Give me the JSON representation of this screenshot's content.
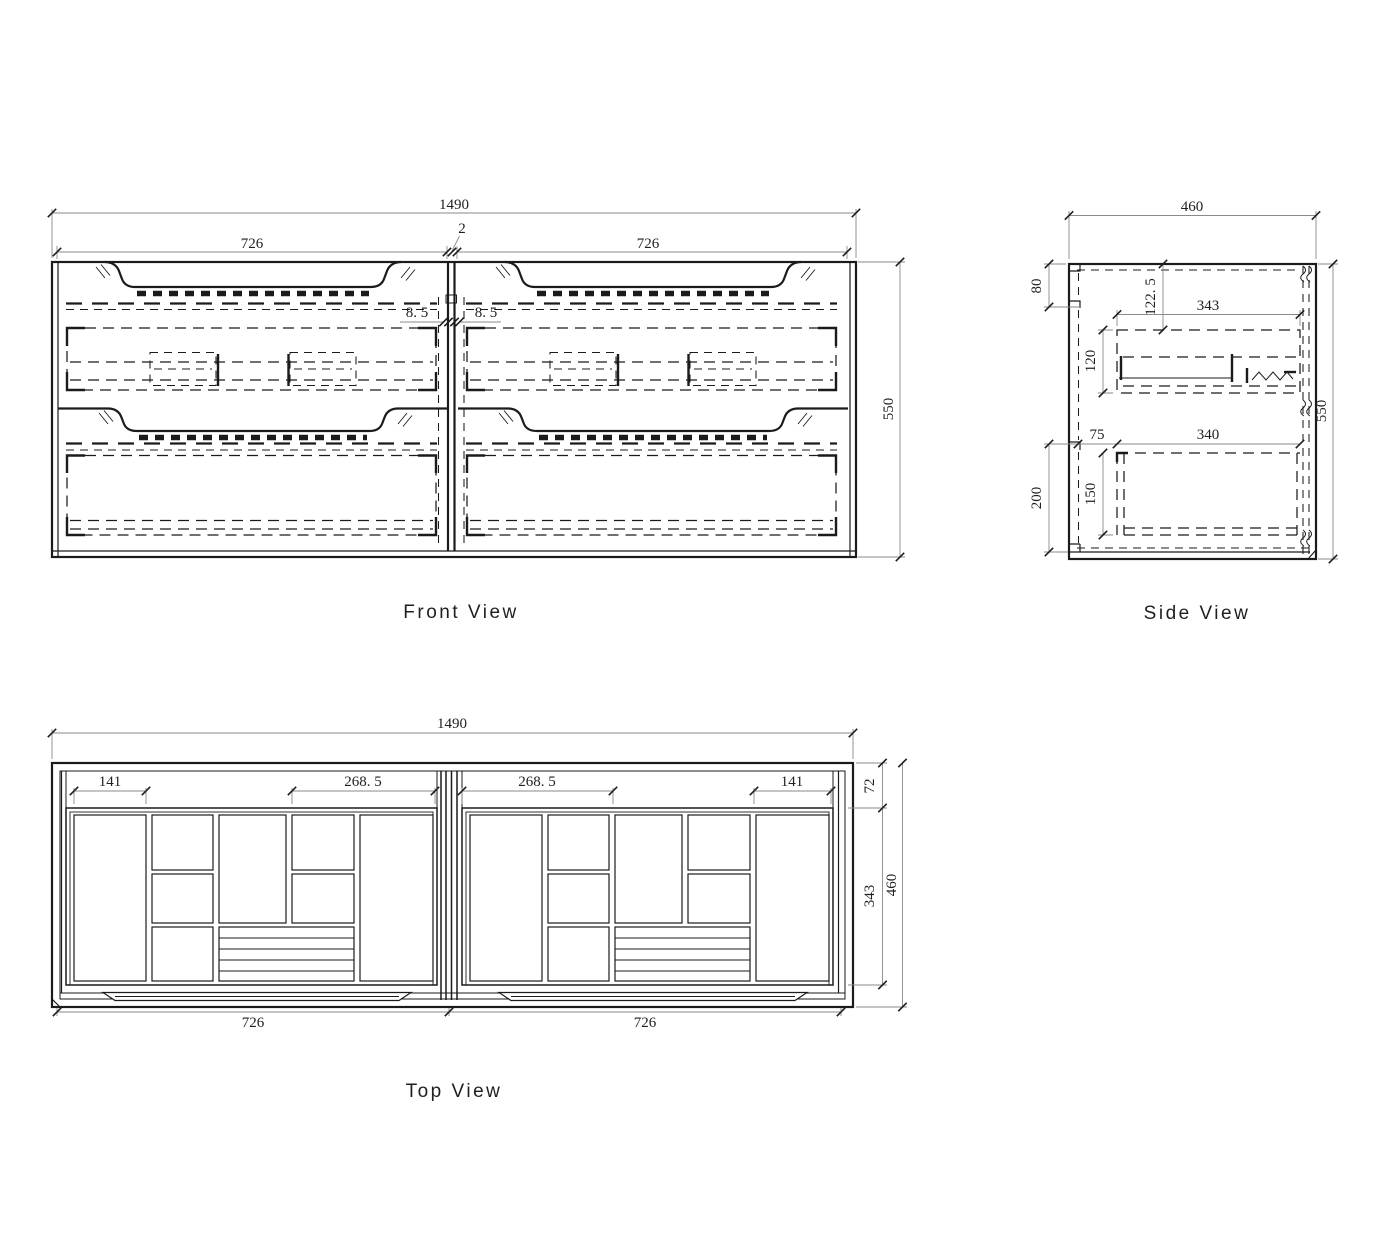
{
  "sheet": {
    "background": "#ffffff",
    "line_color": "#1b1b1b"
  },
  "views": {
    "front": {
      "title": "Front View",
      "dims": {
        "overall_width": "1490",
        "basin_left": "726",
        "basin_right": "726",
        "center_gap": "2",
        "panel_offset_left": "8. 5",
        "panel_offset_right": "8. 5",
        "overall_height": "550"
      }
    },
    "side": {
      "title": "Side View",
      "dims": {
        "overall_depth": "460",
        "wall_rail_top": "80",
        "top_to_drawer": "122. 5",
        "top_drawer_depth": "343",
        "top_drawer_height": "120",
        "front_clearance": "75",
        "bottom_drawer_depth": "340",
        "bottom_drawer_height": "150",
        "wall_rail_bottom": "200",
        "overall_height": "550"
      }
    },
    "top": {
      "title": "Top View",
      "dims": {
        "overall_width": "1490",
        "left_comp": "141",
        "left_inner": "268. 5",
        "right_inner": "268. 5",
        "right_comp": "141",
        "back_rim": "72",
        "tray_depth": "343",
        "overall_depth": "460",
        "basin_left": "726",
        "basin_right": "726"
      }
    }
  }
}
